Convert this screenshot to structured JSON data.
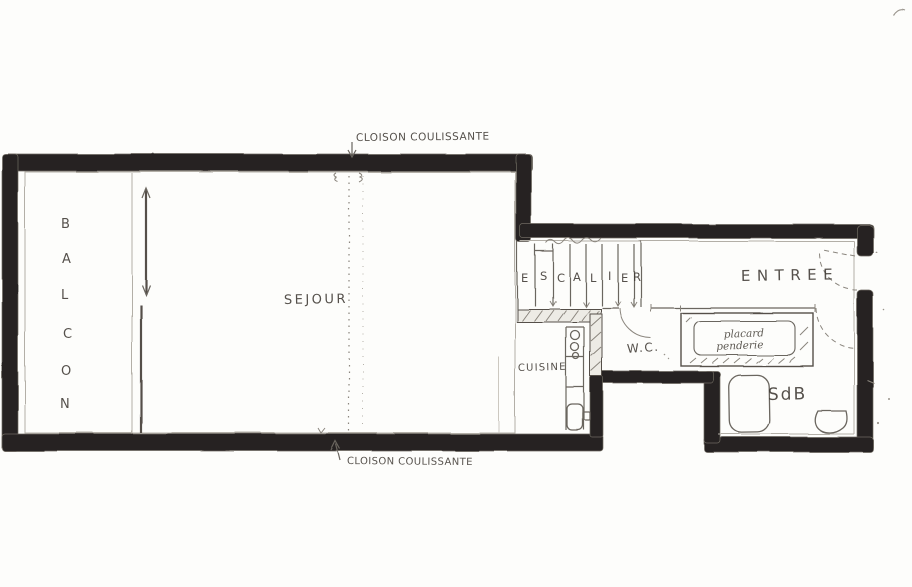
{
  "labels": {
    "cloison_top": "CLOISON COULISSANTE",
    "cloison_bottom": "CLOISON COULISSANTE"
  },
  "rooms": {
    "balcon": {
      "name": "BALCON",
      "letters": [
        "B",
        "A",
        "L",
        "C",
        "O",
        "N"
      ]
    },
    "sejour": "SEJOUR",
    "cuisine": "CUISINE",
    "escalier": {
      "name": "ESCALIER",
      "letters": [
        "E",
        "S",
        "C",
        "A",
        "L",
        "I",
        "E",
        "R"
      ]
    },
    "entree": "ENTREE",
    "wc": "W.C.",
    "placard": {
      "line1": "placard",
      "line2": "penderie"
    },
    "sdb": "SdB"
  },
  "colors": {
    "paper": "#fdfdfb",
    "wall": "#262320",
    "pencil": "#55504a"
  }
}
